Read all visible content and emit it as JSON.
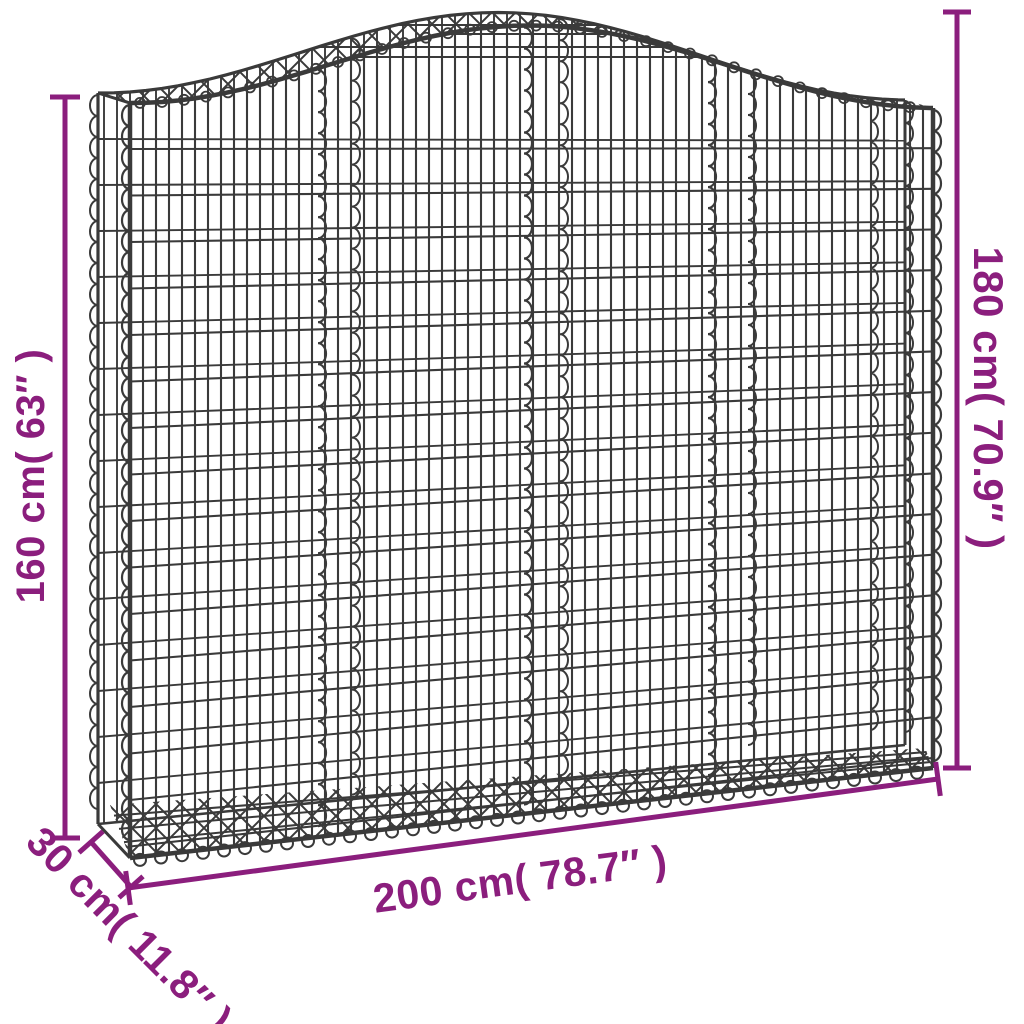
{
  "colors": {
    "accent": "#8B1E7D",
    "wire": "#3A3A3A",
    "background": "#FFFFFF"
  },
  "diagram": {
    "subject": "arched-gabion-basket",
    "labels": {
      "side_height": "160 cm( 63″ )",
      "total_height": "180 cm( 70.9″ )",
      "width": "200 cm( 78.7″ )",
      "depth": "30 cm( 11.8″ )"
    }
  }
}
